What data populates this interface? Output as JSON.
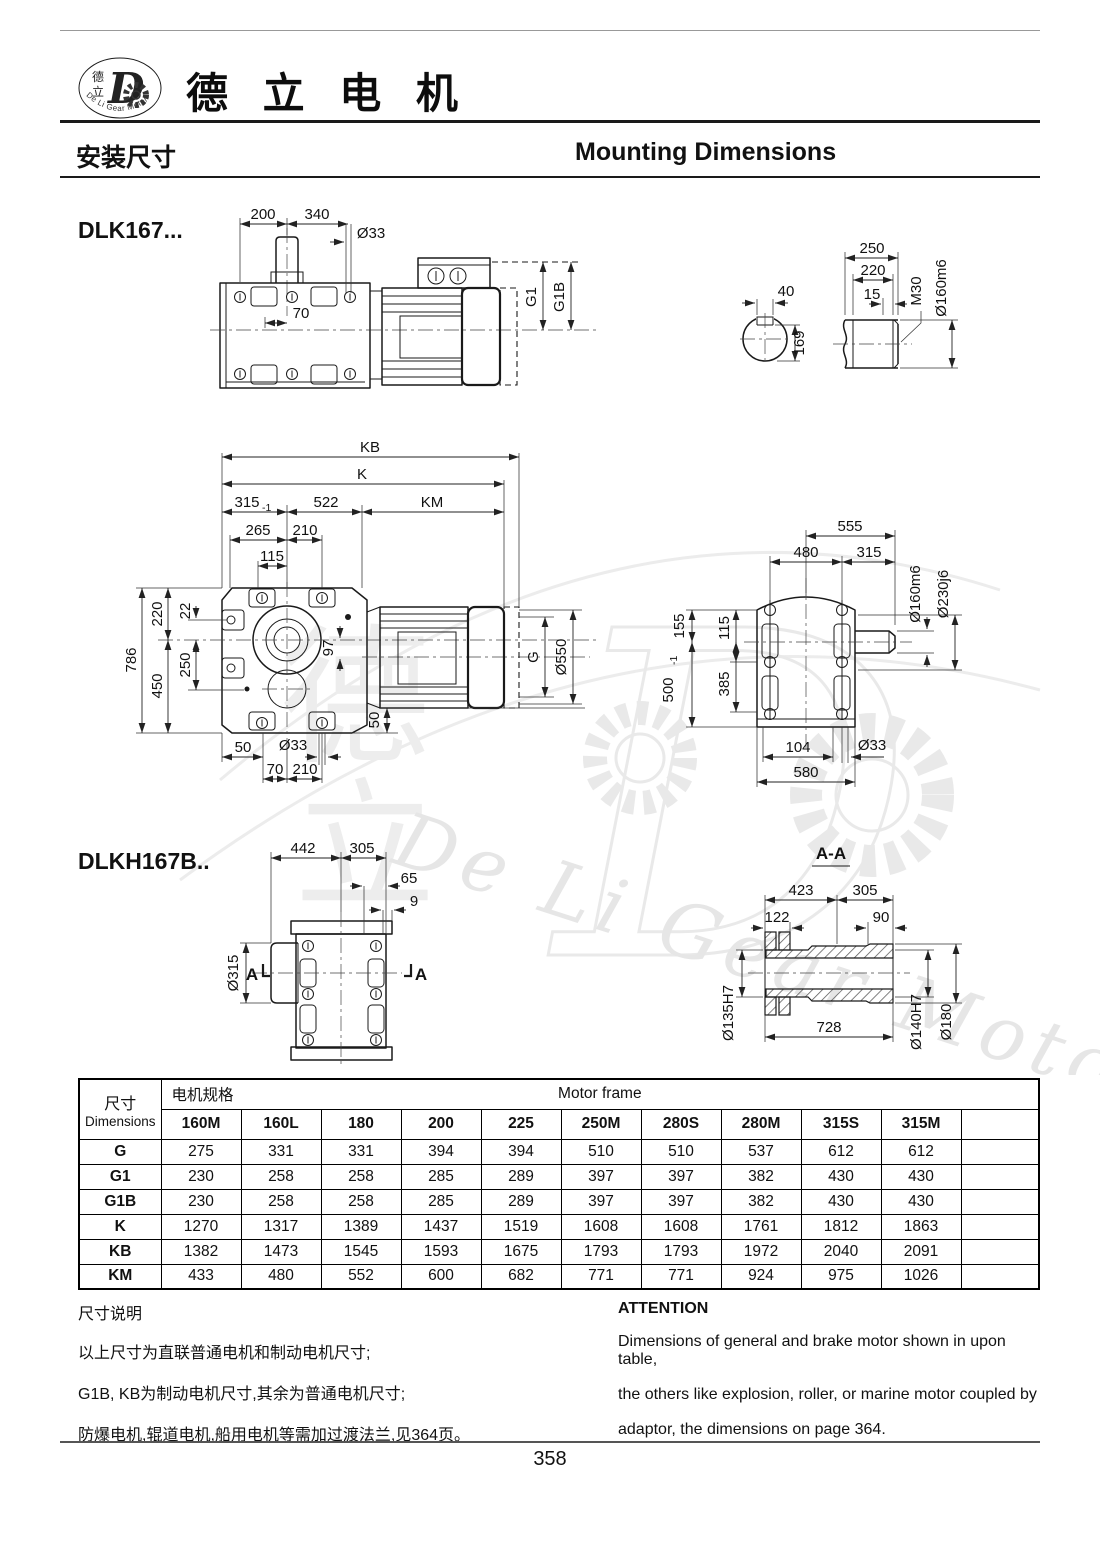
{
  "header": {
    "logo_char1": "德",
    "logo_char2": "立",
    "logo_letter": "D",
    "logo_arc": "De Li Gear Motor",
    "company": "德 立 电 机"
  },
  "section": {
    "zh": "安装尺寸",
    "en": "Mounting Dimensions"
  },
  "drawings": {
    "model1": "DLK167...",
    "model2": "DLKH167B..",
    "top_view": {
      "d200": "200",
      "d340": "340",
      "d33": "Ø33",
      "d70": "70",
      "g1": "G1",
      "g1b": "G1B"
    },
    "shaft": {
      "d40": "40",
      "d169": "169",
      "d250": "250",
      "d220": "220",
      "d15": "15",
      "m30": "M30",
      "d160": "Ø160m6"
    },
    "side_view": {
      "kb": "KB",
      "k": "K",
      "d315": "315",
      "tol": "-1",
      "d522": "522",
      "km": "KM",
      "d265": "265",
      "d210": "210",
      "d115": "115",
      "d786": "786",
      "d220": "220",
      "d22": "22",
      "d250": "250",
      "d450": "450",
      "d97": "97",
      "g": "G",
      "d550": "Ø550",
      "d50a": "50",
      "d33": "Ø33",
      "d50b": "50",
      "d70": "70",
      "d210b": "210"
    },
    "end_view": {
      "d555": "555",
      "d480": "480",
      "d315": "315",
      "d160": "Ø160m6",
      "d230": "Ø230j6",
      "d155": "155",
      "d115": "115",
      "d500": "500",
      "tol": "-1",
      "d385": "385",
      "d104": "104",
      "d33": "Ø33",
      "d580": "580"
    },
    "hollow_view": {
      "d442": "442",
      "d305": "305",
      "d65": "65",
      "d9": "9",
      "d315": "Ø315",
      "a": "A"
    },
    "section_aa": {
      "title": "A-A",
      "d423": "423",
      "d305": "305",
      "d122": "122",
      "d90": "90",
      "d728": "728",
      "d135": "Ø135H7",
      "d140": "Ø140H7",
      "d180": "Ø180"
    }
  },
  "table": {
    "corner_zh": "尺寸",
    "corner_en": "Dimensions",
    "group_zh": "电机规格",
    "group_en": "Motor frame",
    "columns": [
      "160M",
      "160L",
      "180",
      "200",
      "225",
      "250M",
      "280S",
      "280M",
      "315S",
      "315M"
    ],
    "rows": [
      {
        "label": "G",
        "values": [
          "275",
          "331",
          "331",
          "394",
          "394",
          "510",
          "510",
          "537",
          "612",
          "612"
        ]
      },
      {
        "label": "G1",
        "values": [
          "230",
          "258",
          "258",
          "285",
          "289",
          "397",
          "397",
          "382",
          "430",
          "430"
        ]
      },
      {
        "label": "G1B",
        "values": [
          "230",
          "258",
          "258",
          "285",
          "289",
          "397",
          "397",
          "382",
          "430",
          "430"
        ]
      },
      {
        "label": "K",
        "values": [
          "1270",
          "1317",
          "1389",
          "1437",
          "1519",
          "1608",
          "1608",
          "1761",
          "1812",
          "1863"
        ]
      },
      {
        "label": "KB",
        "values": [
          "1382",
          "1473",
          "1545",
          "1593",
          "1675",
          "1793",
          "1793",
          "1972",
          "2040",
          "2091"
        ]
      },
      {
        "label": "KM",
        "values": [
          "433",
          "480",
          "552",
          "600",
          "682",
          "771",
          "771",
          "924",
          "975",
          "1026"
        ]
      }
    ]
  },
  "notes": {
    "zh_title": "尺寸说明",
    "zh_lines": [
      "以上尺寸为直联普通电机和制动电机尺寸;",
      "G1B, KB为制动电机尺寸,其余为普通电机尺寸;",
      "防爆电机,辊道电机,船用电机等需加过渡法兰,见364页。"
    ],
    "en_title": "ATTENTION",
    "en_lines": [
      "Dimensions of general and brake motor shown in upon table,",
      "the others like explosion, roller, or marine motor coupled by",
      "adaptor, the dimensions on page 364."
    ]
  },
  "footer": {
    "page_number": "358"
  },
  "colors": {
    "line": "#1a1a1a",
    "dim": "#222222",
    "watermark": "#e8e8e8",
    "text": "#111111"
  }
}
